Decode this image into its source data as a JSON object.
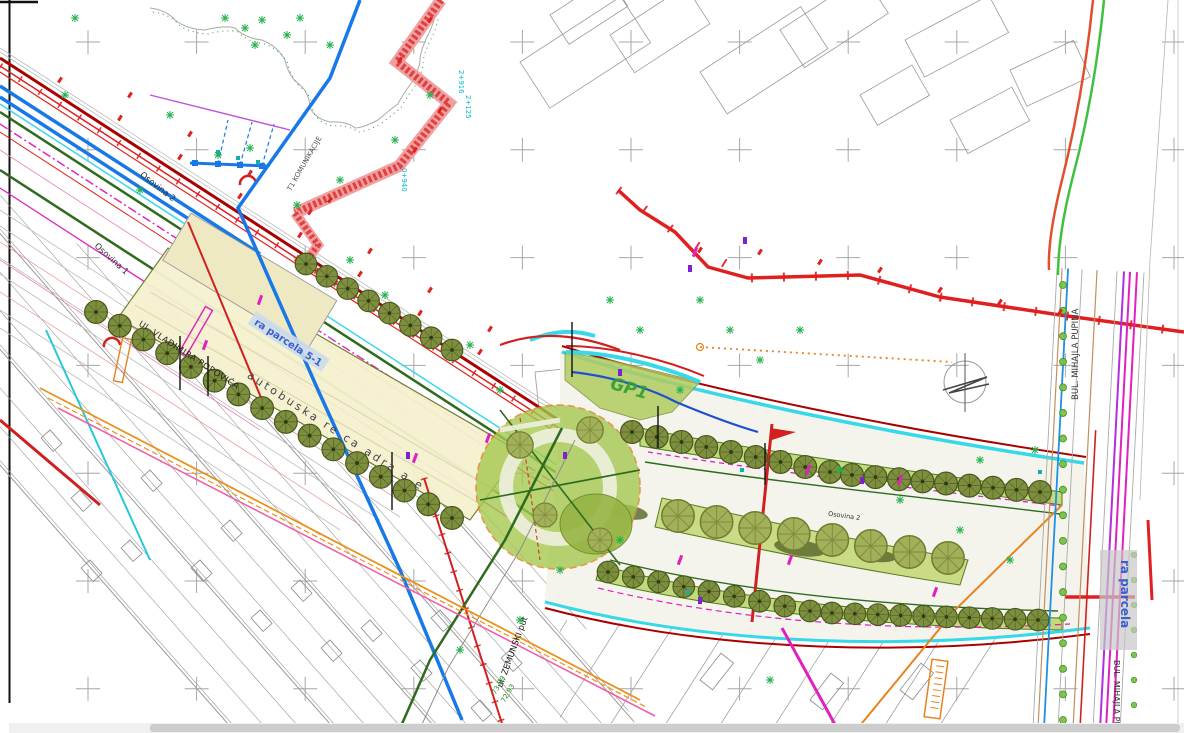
{
  "map": {
    "labels": {
      "osovina_1": "Osovina 1",
      "osovina_2": "Osovina 2",
      "osovina_2b": "Osovina 2",
      "vladimira_popovica": "Ul. VLADIMIRA POPOVIĆA",
      "zemunski_put": "ul. ZEMUNSKI put",
      "mihajla_pupina": "BUL. MIHAJLA PUPINA",
      "mihajla_pupina_2": "BUL. MIHAJLA PUPINA",
      "autobuska": "autobuska re ca adra a e",
      "parcela_51": "ra parcela 5-1",
      "parcela": "ra parcela",
      "gp1": "GP1",
      "t1": "T1 KOMUNIKACIJE",
      "elev_1": "73.89",
      "elev_2": "72.93",
      "ch_1": "2+916",
      "ch_2": "2+125",
      "ch_3": "0+940"
    },
    "colors": {
      "red_line": "#e02020",
      "dark_red": "#aa0000",
      "blue_line": "#1878e8",
      "cyan_highlight": "#38d8e8",
      "green_dark": "#2e6b1e",
      "green_bright": "#22b14c",
      "magenta": "#e020c0",
      "orange": "#e8821e",
      "tree_fill": "#7d8f3e",
      "median_fill": "#c3da7c",
      "circle_fill": "#a6c84f",
      "strip_yellow": "#f5f1cf",
      "label_blue": "#3a5fd0",
      "gp1_green": "#2fa02f"
    }
  }
}
